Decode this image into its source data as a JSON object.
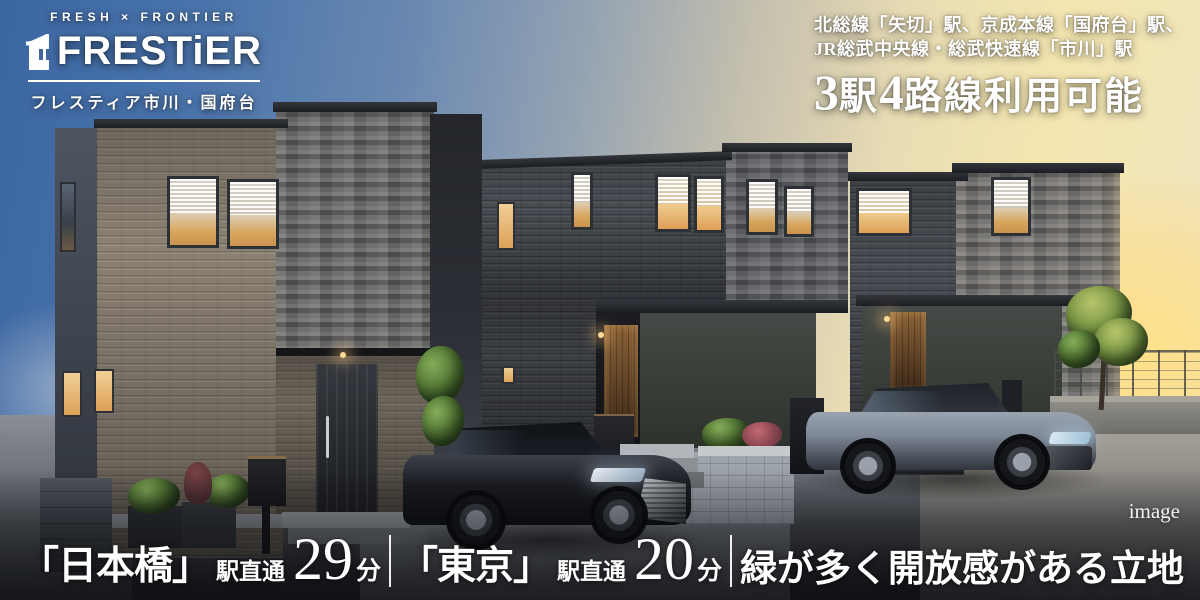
{
  "logo": {
    "tagline": "FRESH × FRONTIER",
    "brand": "FRESTiER",
    "subtitle": "フレスティア市川・国府台"
  },
  "access_note": {
    "line1": "北総線「矢切」駅、京成本線「国府台」駅、",
    "line2": "JR総武中央線・総武快速線「市川」駅",
    "headline": {
      "num1": "3",
      "unit1": "駅",
      "num2": "4",
      "rest": "路線利用可能"
    }
  },
  "bottom_bar": {
    "routes": [
      {
        "station": "「日本橋」",
        "label": "駅直通",
        "minutes": "29",
        "unit": "分"
      },
      {
        "station": "「東京」",
        "label": "駅直通",
        "minutes": "20",
        "unit": "分"
      }
    ],
    "feature": "緑が多く開放感がある立地"
  },
  "watermark": "image",
  "colors": {
    "sky_blue": "#4a74ab",
    "sunset_gold": "#f8e7a8",
    "text_white": "#ffffff",
    "brick_light": "#8b8173",
    "brick_dark": "#484b51",
    "stone_gray": "#595b5f",
    "window_glow": "#e2a95f",
    "asphalt_dark": "#26282d"
  }
}
